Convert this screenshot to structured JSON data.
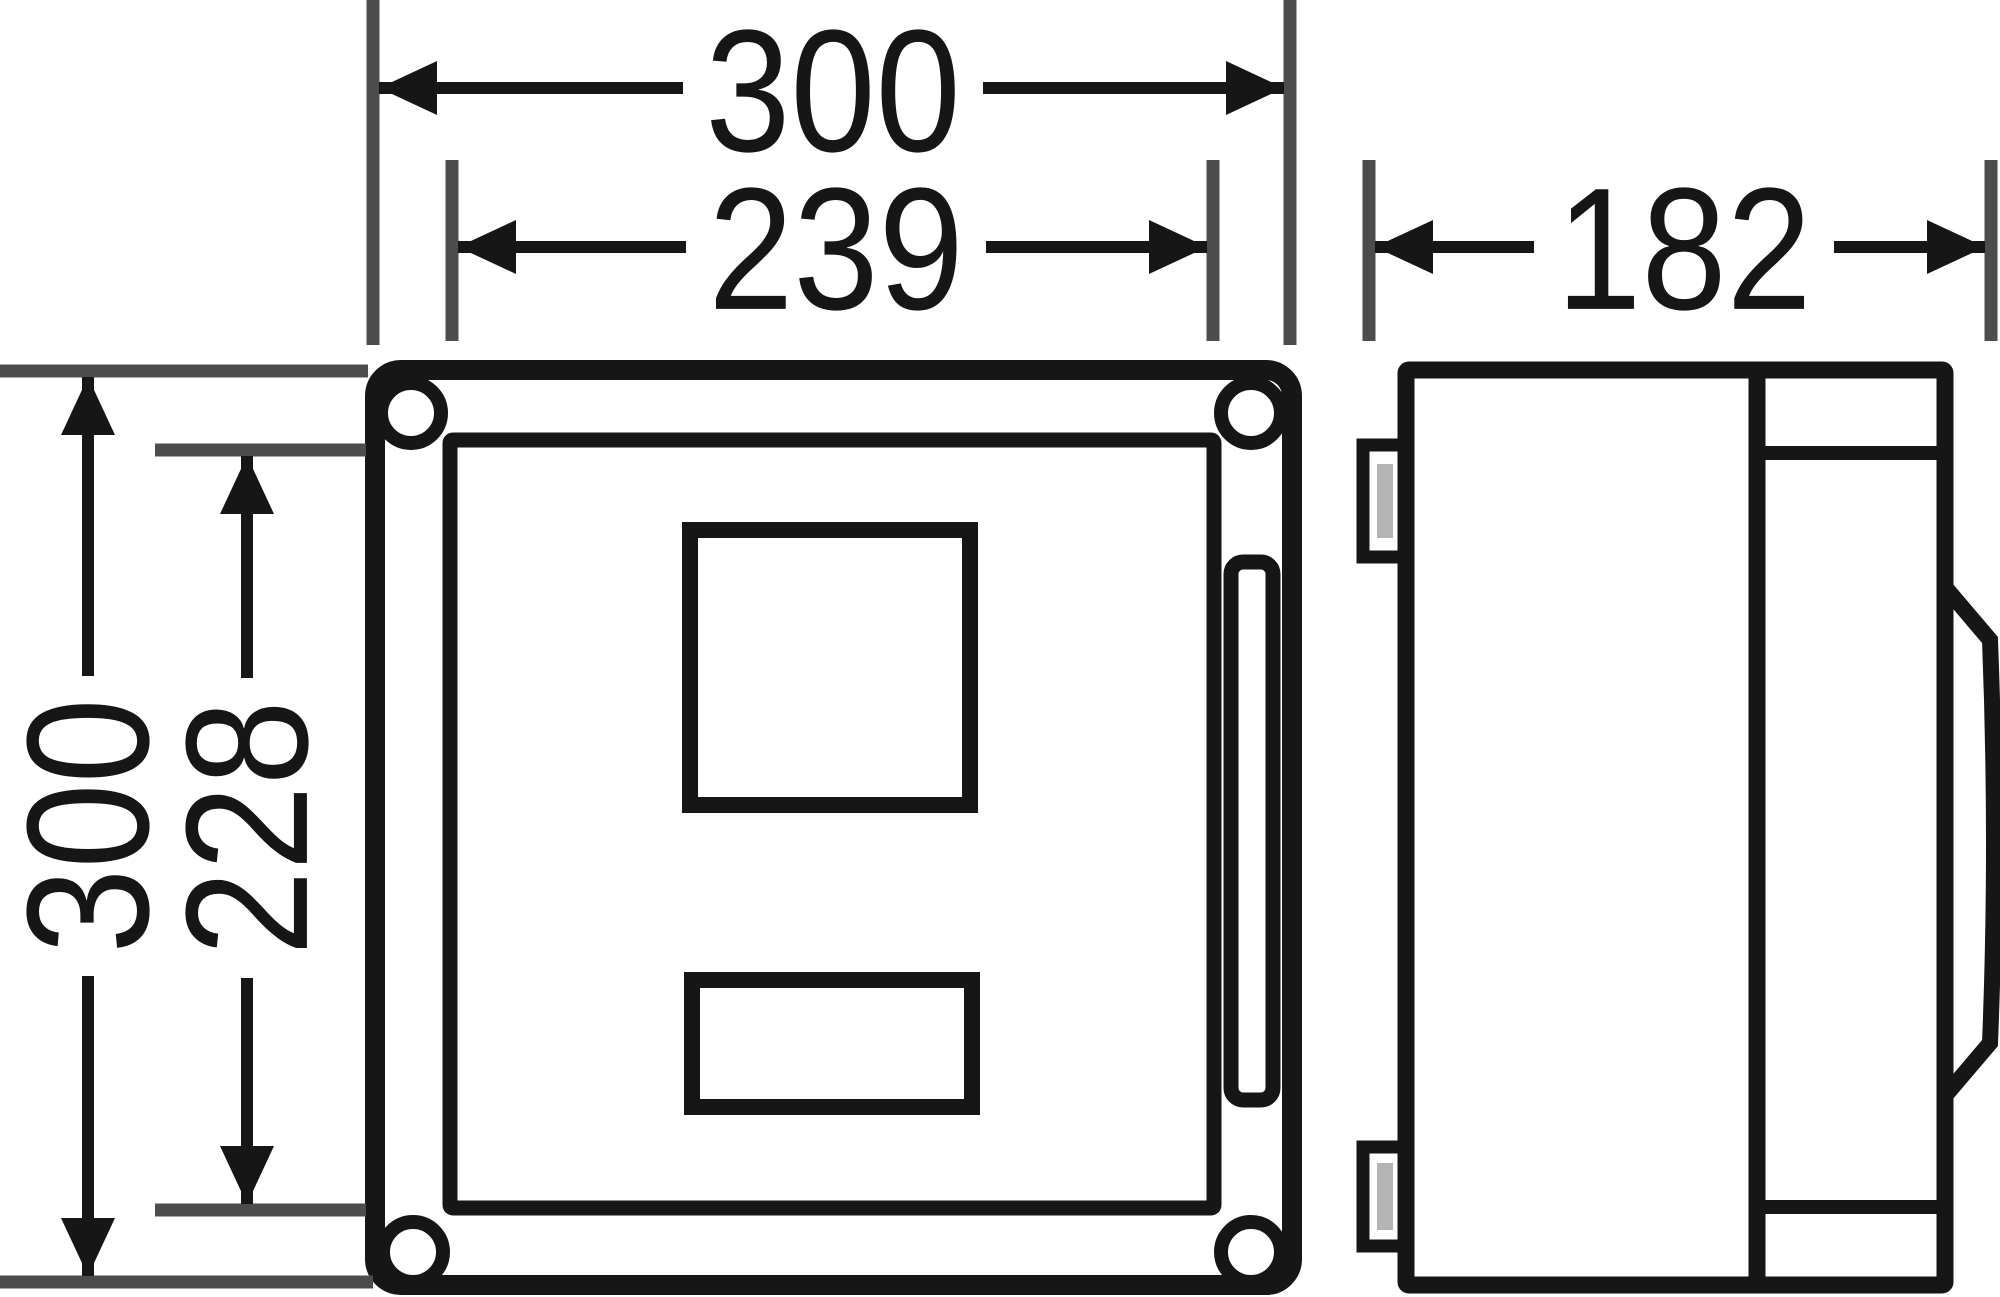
{
  "document": {
    "type": "technical-dimension-drawing",
    "views": {
      "front_view": "enclosure front view with cover, four corner screws, two cutouts and latch slot",
      "side_view": "enclosure side view with hinge tabs and curved cover bulge"
    }
  },
  "dimensions": {
    "outer_width": "300",
    "inner_width": "239",
    "depth": "182",
    "outer_height": "300",
    "inner_height": "228"
  },
  "colors": {
    "background": "#ffffff",
    "drawing_line": "#161616",
    "extension_line": "#4c4c4c",
    "hinge_slit_fill": "#b4b4b4",
    "label_text": "#161616"
  }
}
